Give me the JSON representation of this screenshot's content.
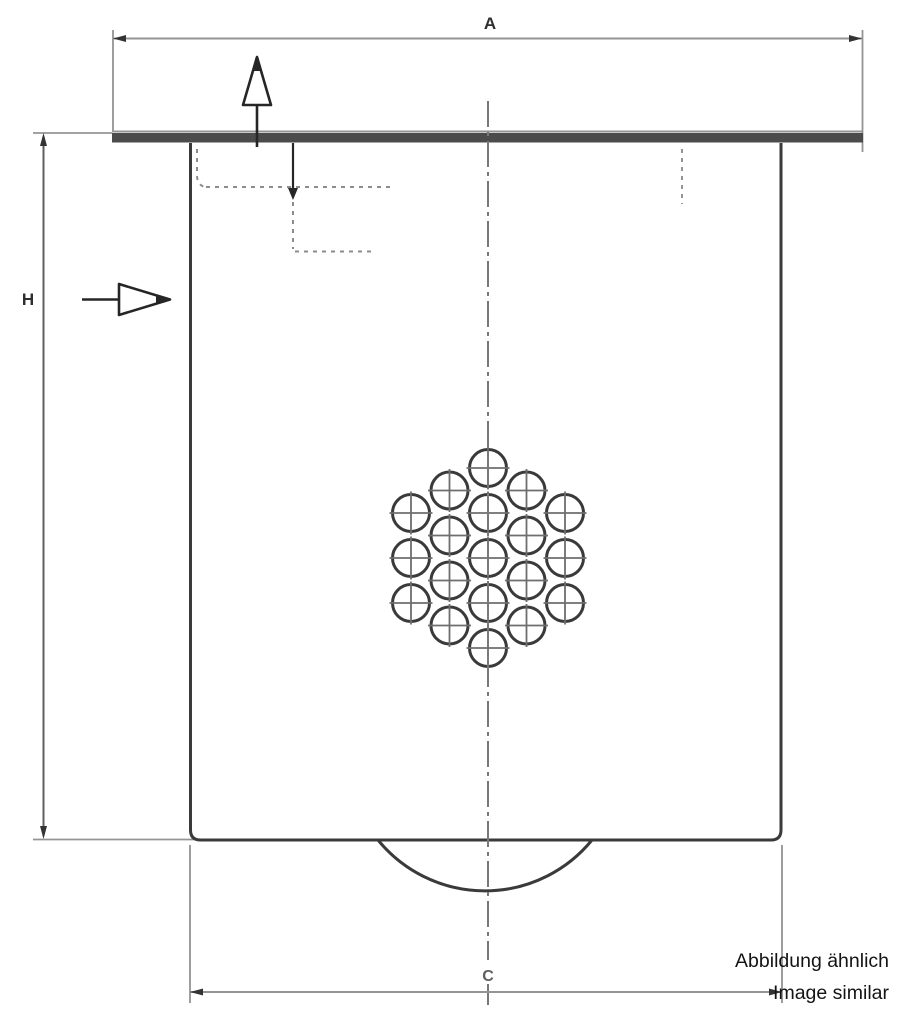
{
  "drawing": {
    "type": "technical-dimensional-drawing",
    "subject": "air-oil separator filter element, front view",
    "dimension_labels": {
      "top_width": "A",
      "left_height": "H",
      "bottom_width": "C"
    },
    "note": {
      "line1": "Abbildung ähnlich",
      "line2": "Image similar"
    },
    "perforation": {
      "hole_count": 19,
      "pattern": "hexagonal cluster, rows 3-4-5-4-3, crosshair in each hole"
    },
    "flow_symbols": {
      "outlet": "hollow arrow pointing up on top flange",
      "inlet": "hollow arrow pointing right at left side"
    },
    "colors": {
      "outline_dark": "#3a3a3a",
      "dimension_gray": "#949494",
      "dim_strong": "#5f5f5f",
      "centerline_gray": "#787878",
      "crosshair_gray": "#6e6e6e",
      "flow_dash_gray": "#8c8c8c",
      "flow_arrow_dark": "#262626",
      "flange_fill": "#4b4b4b",
      "label_dark": "#2e2e2e",
      "note_text": "#141414",
      "arrow_dark": "#333333"
    }
  }
}
